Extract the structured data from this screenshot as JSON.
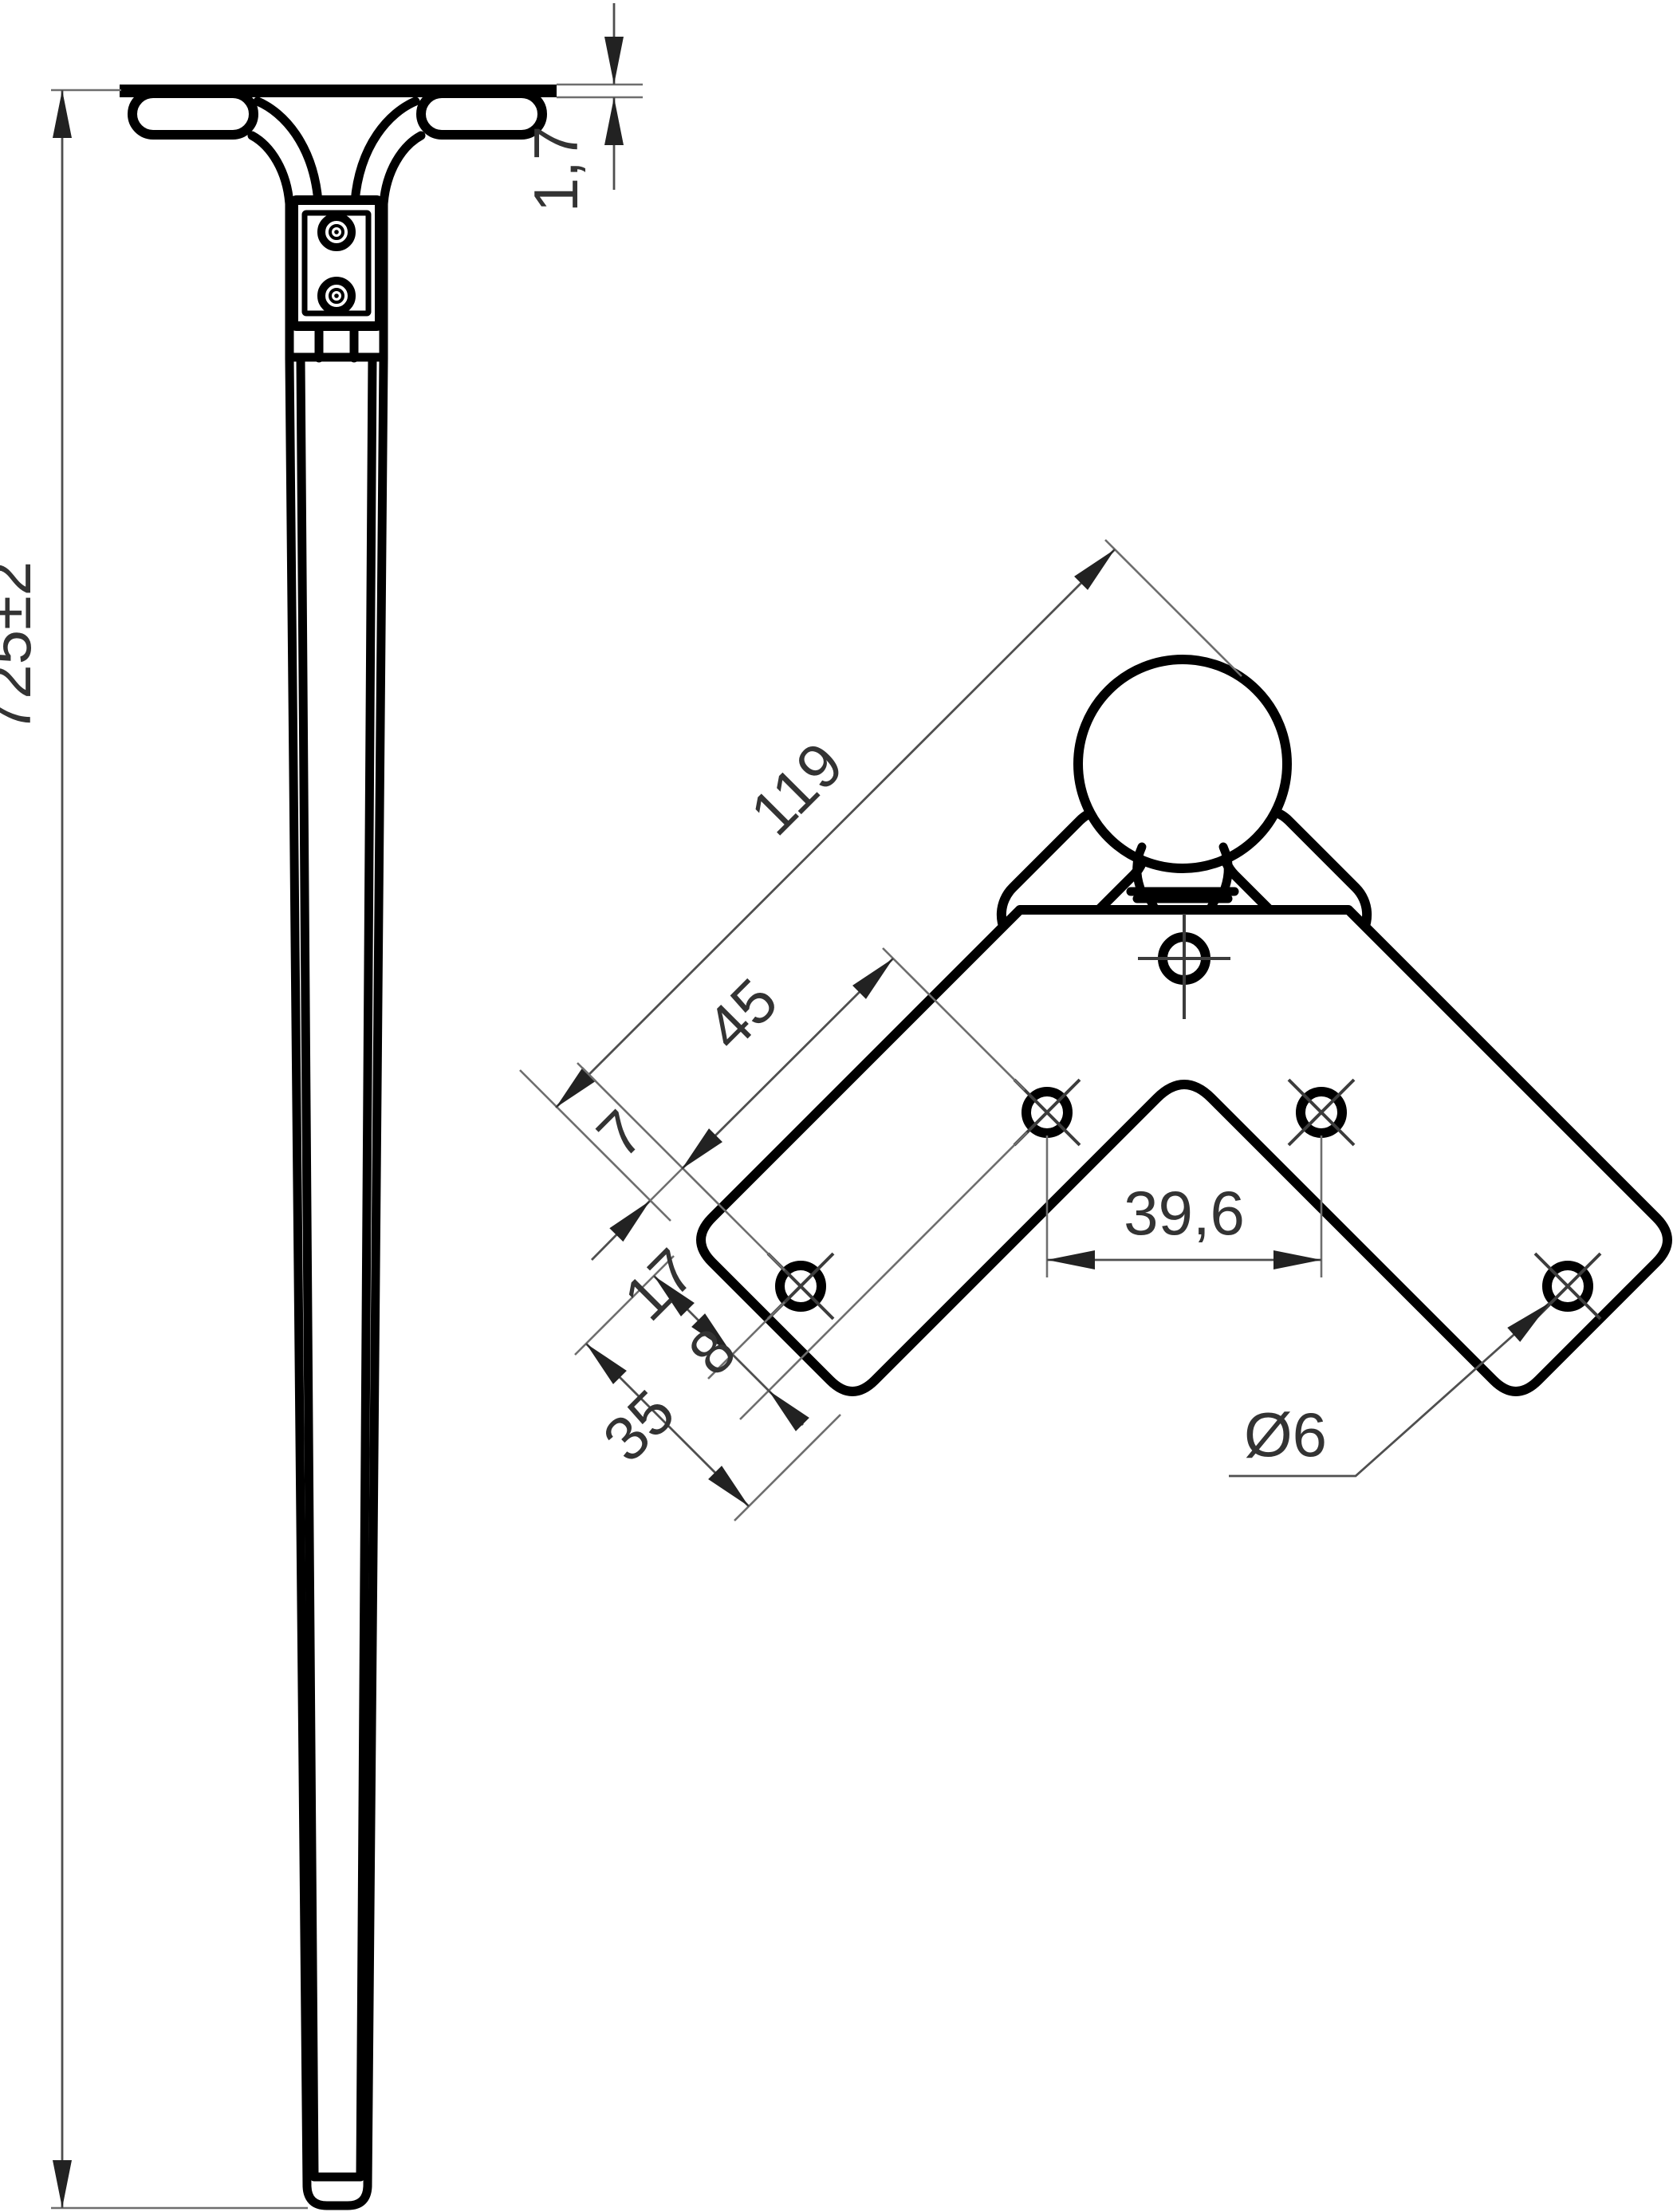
{
  "app": {
    "type": "cad-technical-drawing",
    "background": "#ffffff",
    "units": "mm"
  },
  "drawing": {
    "side_view": {
      "name": "table-leg-side-view",
      "dimensions": {
        "overall_height": "725±2",
        "plate_thickness": "1,7"
      }
    },
    "top_view": {
      "name": "corner-mounting-plate-top-view",
      "dimensions": {
        "overall_length": "119",
        "hole_pitch_along_arm": "45",
        "end_to_hole": "7",
        "edge_to_hole_row": "17",
        "hole_row_gap": "8",
        "plate_width": "35",
        "center_hole_spacing": "39,6",
        "hole_diameter": "Ø6"
      }
    },
    "colors": {
      "outline": "#000000",
      "dimension_line": "#4f4f4f",
      "extension_line": "#6e6e6e",
      "label": "#333333"
    }
  }
}
